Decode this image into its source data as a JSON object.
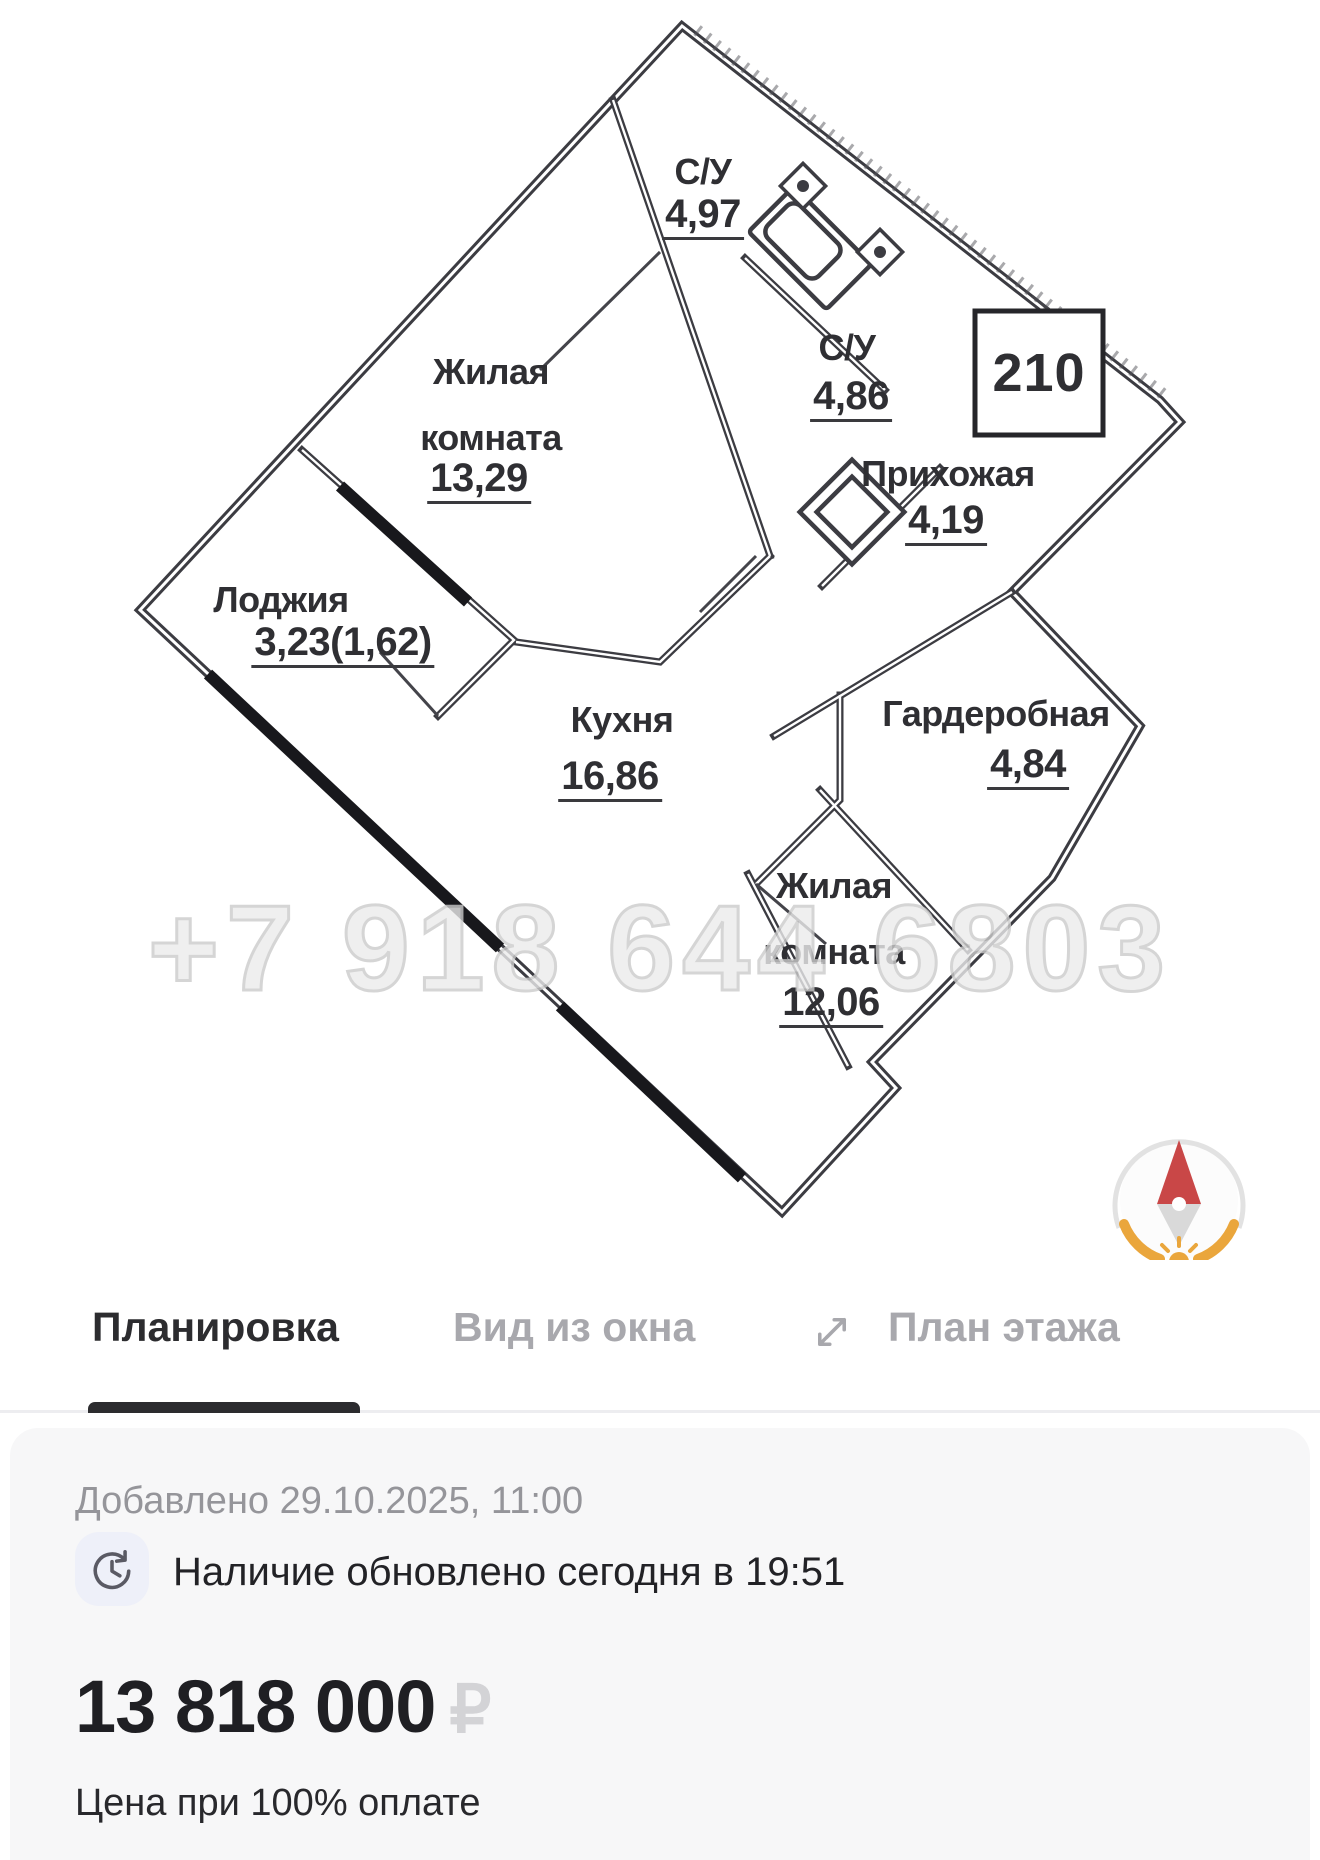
{
  "floor_plan": {
    "unit_number": "210",
    "watermark": "+7 918 644 6803",
    "rooms": [
      {
        "name": "С/У",
        "area": "4,97"
      },
      {
        "name": "Жилая комната",
        "area": "13,29"
      },
      {
        "name": "С/У",
        "area": "4,86"
      },
      {
        "name": "Прихожая",
        "area": "4,19"
      },
      {
        "name": "Лоджия",
        "area": "3,23(1,62)"
      },
      {
        "name": "Кухня",
        "area": "16,86"
      },
      {
        "name": "Гардеробная",
        "area": "4,84"
      },
      {
        "name": "Жилая комната",
        "area": "12,06"
      }
    ],
    "icons": {
      "compass": "north-needle-with-sun"
    }
  },
  "tabs": [
    {
      "label": "Планировка",
      "active": true
    },
    {
      "label": "Вид из окна",
      "active": false
    },
    {
      "label": "План этажа",
      "active": false
    }
  ],
  "icons": {
    "expand": "diagonal-arrows-icon",
    "availability": "clock-refresh-icon"
  },
  "details": {
    "added": "Добавлено 29.10.2025, 11:00",
    "availability": "Наличие обновлено сегодня в 19:51",
    "price": "13 818 000",
    "currency": "₽",
    "price_note": "Цена при 100% оплате"
  },
  "colors": {
    "wall": "#3c3c42",
    "black_wall": "#18181c",
    "tab_active": "#2c2c2f",
    "tab_inactive": "#a8a8ad",
    "card_bg": "#f7f7f8",
    "secondary_text": "#95959a",
    "price_text": "#1f1f23",
    "currency_muted": "#d3d3d6",
    "compass_orange": "#eaa63c",
    "compass_red": "#c94747",
    "watermark": "#cbcbcb"
  }
}
